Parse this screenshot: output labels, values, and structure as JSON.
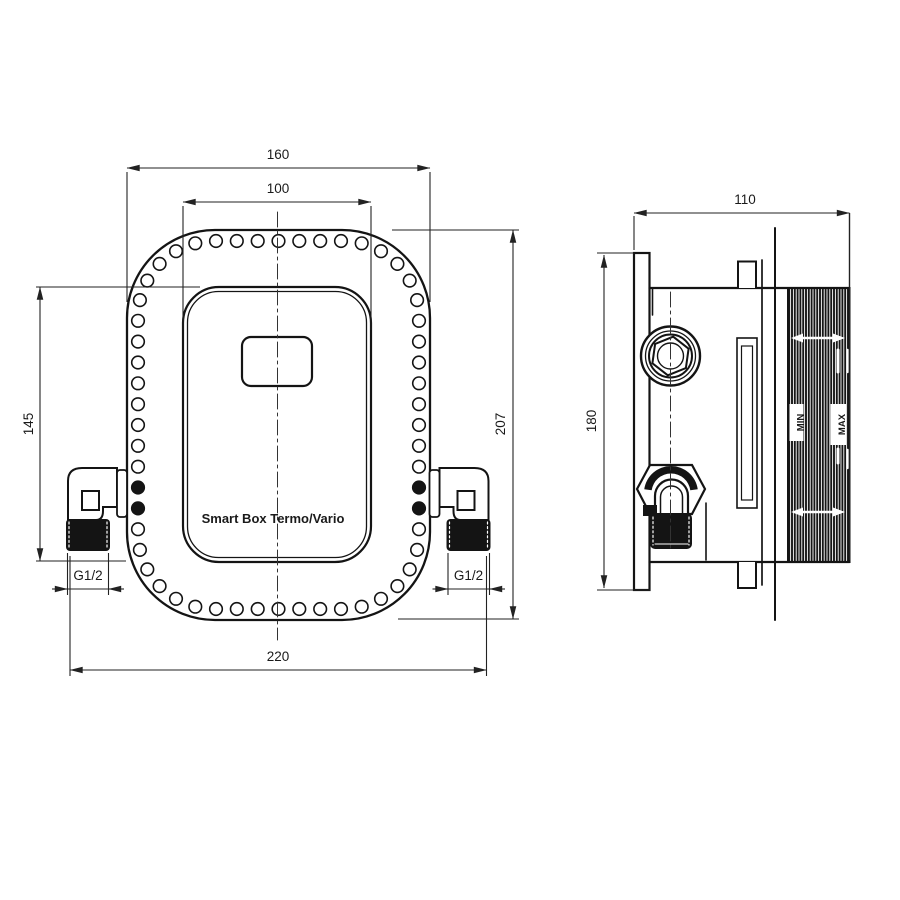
{
  "product_label": "Smart Box Termo/Vario",
  "front_view": {
    "outer_width": "160",
    "inner_width": "100",
    "inner_height": "145",
    "outer_height": "207",
    "total_width": "220",
    "left_thread": "G1/2",
    "right_thread": "G1/2"
  },
  "side_view": {
    "depth": "110",
    "plate_height": "180",
    "min_label": "MIN",
    "max_label": "MAX"
  },
  "colors": {
    "line": "#141414",
    "dim": "#222222",
    "background": "#ffffff"
  }
}
